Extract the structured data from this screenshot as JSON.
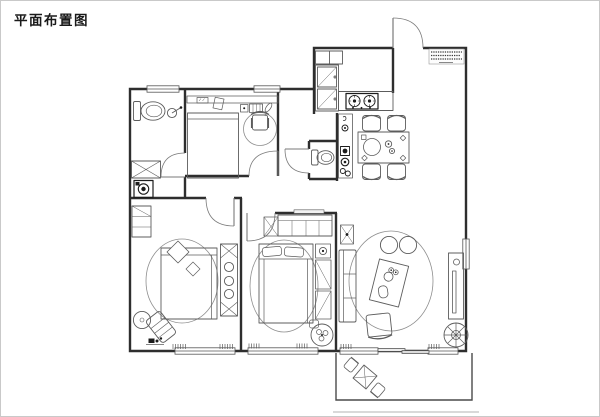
{
  "page": {
    "title": "平面布置图",
    "background": "#ffffff",
    "frame_color": "#c9c9c9"
  },
  "drawing": {
    "wall_color": "#2e2e2e",
    "furniture_color": "#5c5c5c",
    "appliance_color": "#1c1c1c",
    "rug_color": "#8e8e8e",
    "window_color": "#555555",
    "door_color": "#7a7a7a",
    "balcony_color": "#4a4a4a",
    "note_color": "#3a3a3a",
    "terrace_line_color": "#b3b3b3",
    "entry_note": {
      "legible": false,
      "lines": 4
    },
    "symbols": [
      "entry-door-arc",
      "interior-door-arc",
      "window",
      "sliding-door",
      "wall",
      "kitchen-stove",
      "kitchen-counter",
      "tall-cabinet",
      "upper-cabinet",
      "dining-table",
      "dining-chair",
      "console-shelf",
      "toilet",
      "shower-head",
      "bath-cabinet",
      "washing-machine",
      "desk-shelf",
      "office-chair",
      "single-bed",
      "double-bed",
      "pillow",
      "wardrobe",
      "nightstand",
      "dresser",
      "round-rug",
      "oval-rug",
      "chaise-lounge",
      "side-table",
      "floor-lamp",
      "curtain-mark",
      "sofa",
      "coffee-table",
      "pouf",
      "armchair",
      "tv-cabinet",
      "wall-art",
      "potted-plant",
      "plant-table",
      "balcony-bistro-table",
      "balcony-chair",
      "spec-annotation"
    ]
  }
}
